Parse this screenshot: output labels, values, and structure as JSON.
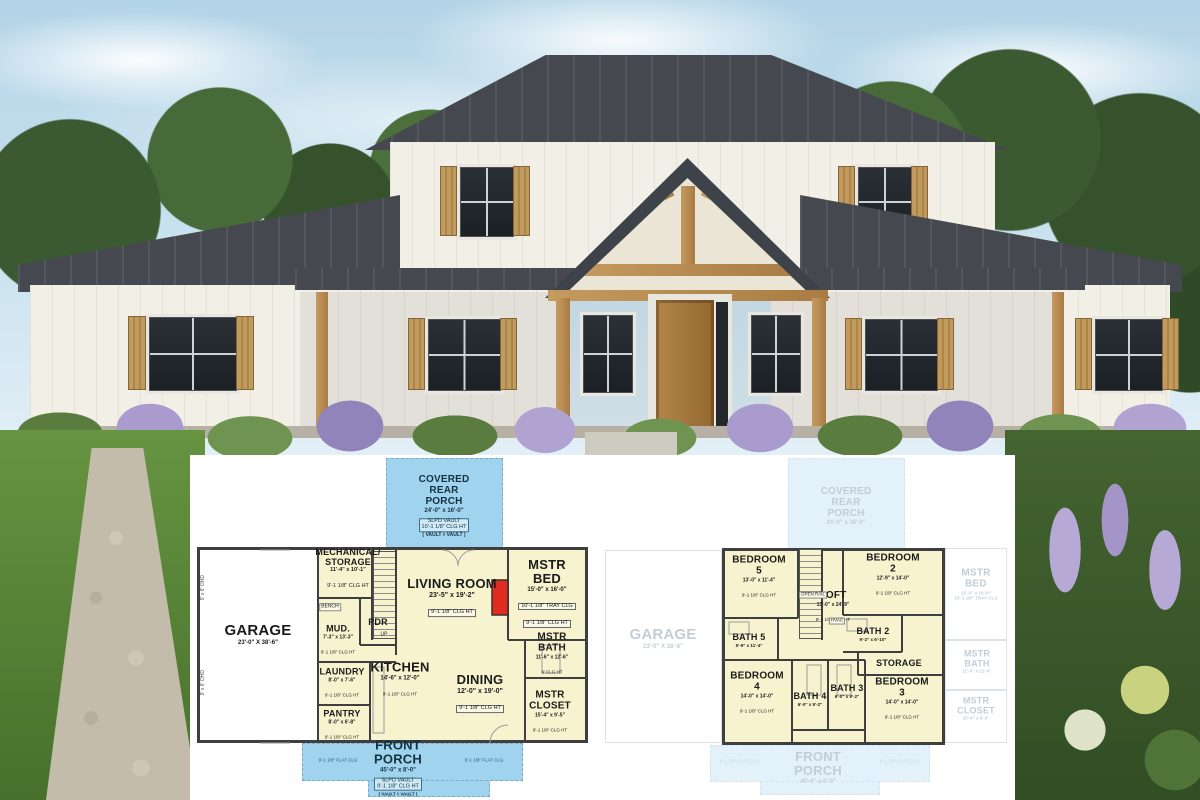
{
  "palette": {
    "roof": "#45494f",
    "siding": "#f2efe6",
    "wood_trim": "#b8894d",
    "plan_room_fill": "#f7f3cf",
    "porch_blue": "#9fd3ee",
    "faded_blue": "#e3f1fb",
    "wall_line": "#3f3f3f",
    "fireplace_red": "#e02b20",
    "lawn": "#679441"
  },
  "plans": {
    "first_floor": {
      "rear_porch": {
        "label": "COVERED REAR PORCH",
        "dims": "24'-0\" x 16'-0\"",
        "vault1": "SLPD VAULT",
        "vault2": "10'-1 1/8\" CLG HT",
        "vault3": "( VAULT ◊ VAULT )"
      },
      "front_porch": {
        "label": "FRONT PORCH",
        "dims": "45'-0\" x 8'-0\"",
        "vault1": "SLPD VAULT",
        "vault2": "9'-1 1/8\" CLG HT",
        "vault3": "( VAULT ◊ VAULT )",
        "flat_left": "9'-1 1/8\" FLAT CLG",
        "flat_right": "9'-1 1/8\" FLAT CLG"
      },
      "rooms": {
        "garage": {
          "label": "GARAGE",
          "dims": "23'-0\" X 38'-6\""
        },
        "mechanical": {
          "label": "MECHANICAL/ STORAGE",
          "dims": "11'-4\" x 10'-1\"",
          "clg": "9'-1 1/8\" CLG HT"
        },
        "pdr": {
          "label": "PDR"
        },
        "mud": {
          "label": "MUD.",
          "dims": "7'-3\" x 13'-3\"",
          "clg": "9'-1 1/8\" CLG HT"
        },
        "living": {
          "label": "LIVING ROOM",
          "dims": "23'-5\" x 19'-2\"",
          "clg": "9'-1 1/8\" CLG HT"
        },
        "mstr_bed": {
          "label": "MSTR BED",
          "dims": "15'-0\" x 16'-0\"",
          "tray": "10'-1 1/8\" TRAY CLG",
          "clg": "9'-1 1/8\" CLG HT"
        },
        "mstr_bath": {
          "label": "MSTR BATH",
          "dims": "11'-6\" x 12'-6\"",
          "clg": "9' CLG HT"
        },
        "laundry": {
          "label": "LAUNDRY",
          "dims": "8'-0\" x 7'-6\"",
          "clg": "9'-1 1/8\" CLG HT"
        },
        "kitchen": {
          "label": "KITCHEN",
          "dims": "14'-6\" x 12'-0\"",
          "clg": "9'-1 1/8\" CLG HT"
        },
        "dining": {
          "label": "DINING",
          "dims": "12'-0\" x 19'-0\"",
          "clg": "9'-1 1/8\" CLG HT"
        },
        "pantry": {
          "label": "PANTRY",
          "dims": "8'-0\" x 6'-8\"",
          "clg": "9'-1 1/8\" CLG HT"
        },
        "mstr_closet": {
          "label": "MSTR CLOSET",
          "dims": "15'-4\" x 9'-5\"",
          "clg": "9'-1 1/8\" CLG HT"
        }
      },
      "annotations": {
        "bench": "BENCH",
        "up": "UP",
        "ohd": "9' x 8' OHD"
      }
    },
    "second_floor": {
      "rooms": {
        "bedroom5": {
          "label": "BEDROOM 5",
          "dims": "13'-0\" x 11'-4\"",
          "clg": "9'-1 1/8\" CLG HT"
        },
        "loft": {
          "label": "LOFT",
          "dims": "13'-0\" x 24'-9\"",
          "clg": "9'-1 1/8\" CLG HT"
        },
        "bedroom2": {
          "label": "BEDROOM 2",
          "dims": "12'-9\" x 14'-0\"",
          "clg": "9'-1 1/8\" CLG HT"
        },
        "bath5": {
          "label": "BATH 5",
          "dims": "5'-9\" x 11'-4\""
        },
        "bath2": {
          "label": "BATH 2",
          "dims": "9'-2\" x 6'-10\""
        },
        "storage": {
          "label": "STORAGE"
        },
        "bedroom4": {
          "label": "BEDROOM 4",
          "dims": "14'-0\" x 14'-0\"",
          "clg": "9'-1 1/8\" CLG HT"
        },
        "bath4": {
          "label": "BATH 4",
          "dims": "6'-0\" x 9'-2\""
        },
        "bath3": {
          "label": "BATH 3",
          "dims": "6'-0\" x 9'-2\""
        },
        "bedroom3": {
          "label": "BEDROOM 3",
          "dims": "14'-0\" x 14'-0\"",
          "clg": "9'-1 1/8\" CLG HT"
        }
      },
      "annotations": {
        "open_rail": "OPEN RAIL",
        "hvac": "HVAC"
      },
      "faded": {
        "rear_porch": {
          "label": "COVERED REAR PORCH",
          "dims": "24'-0\" x 16'-0\""
        },
        "garage": {
          "label": "GARAGE",
          "dims": "23'-0\" X 38'-6\""
        },
        "mstr_bed": {
          "label": "MSTR BED",
          "dims": "15'-0\" x 16'-0\"",
          "note": "10'-1 1/8\" TRAY CLG"
        },
        "mstr_bath": {
          "label": "MSTR BATH",
          "dims": "11'-6\" x 12'-6\""
        },
        "mstr_closet": {
          "label": "MSTR CLOSET",
          "dims": "15'-4\" x 9'-5\""
        },
        "front_porch": {
          "label": "FRONT PORCH",
          "dims": "45'-0\" x 8'-0\"",
          "flat": "9'-1 1/8\" FLAT CLG"
        }
      }
    }
  }
}
